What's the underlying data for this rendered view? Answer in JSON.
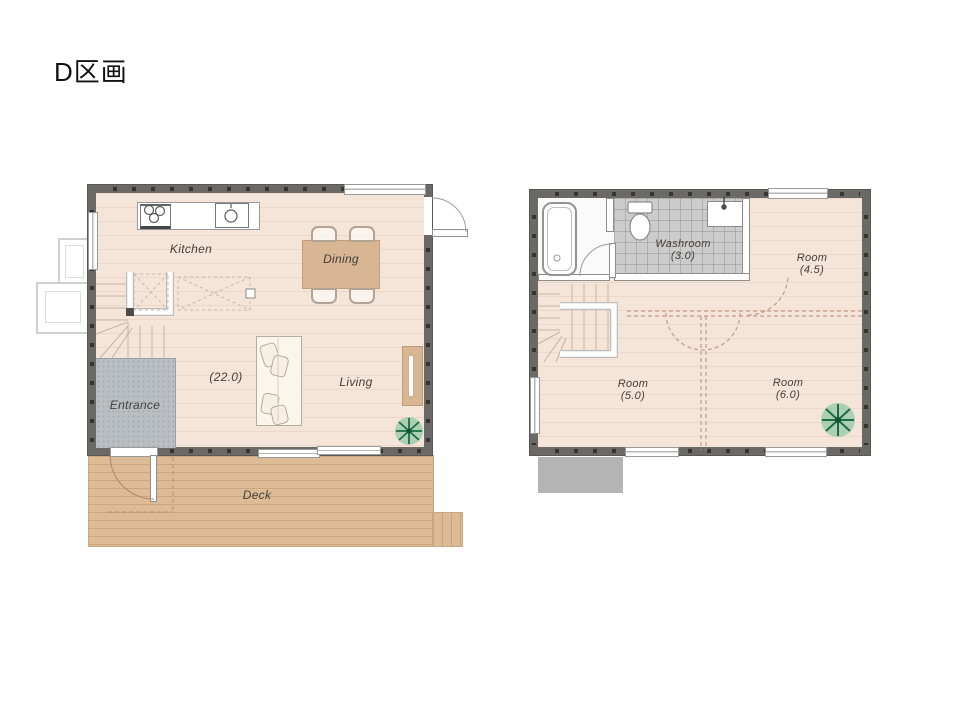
{
  "title": "D区画",
  "floor1": {
    "labels": {
      "kitchen": "Kitchen",
      "dining": "Dining",
      "living": "Living",
      "entrance": "Entrance",
      "area_total": "(22.0)",
      "deck": "Deck"
    }
  },
  "floor2": {
    "labels": {
      "washroom": "Washroom",
      "washroom_area": "(3.0)",
      "room_a": "Room",
      "room_a_area": "(4.5)",
      "room_b": "Room",
      "room_b_area": "(5.0)",
      "room_c": "Room",
      "room_c_area": "(6.0)"
    }
  },
  "colors": {
    "wall": "#6b6966",
    "floor": "#f5e4d8",
    "deck": "#debb97",
    "entrance_floor": "#b9bec2",
    "washroom_tile": "#cccccc",
    "furniture_wood": "#d8b593",
    "plant_green": "#1d6e41",
    "porch_gray": "#b4b4b4"
  }
}
